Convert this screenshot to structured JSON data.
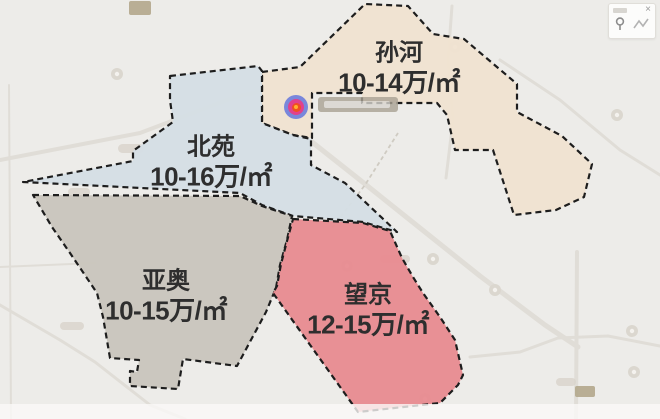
{
  "regions": [
    {
      "id": "sunhe",
      "name": "孙河",
      "price": "10-14万/㎡",
      "fill": "#f0e3d1",
      "label": {
        "x": 399,
        "y": 69
      },
      "polygon": [
        [
          262,
          72
        ],
        [
          300,
          67
        ],
        [
          365,
          4
        ],
        [
          408,
          6
        ],
        [
          433,
          34
        ],
        [
          464,
          39
        ],
        [
          517,
          84
        ],
        [
          517,
          112
        ],
        [
          562,
          136
        ],
        [
          592,
          164
        ],
        [
          584,
          197
        ],
        [
          556,
          210
        ],
        [
          514,
          215
        ],
        [
          493,
          150
        ],
        [
          455,
          150
        ],
        [
          447,
          115
        ],
        [
          437,
          103
        ],
        [
          362,
          103
        ],
        [
          362,
          93
        ],
        [
          312,
          93
        ],
        [
          312,
          138
        ],
        [
          293,
          135
        ],
        [
          262,
          123
        ]
      ]
    },
    {
      "id": "beiyuan",
      "name": "北苑",
      "price": "10-16万/㎡",
      "fill": "#d5dee5",
      "label": {
        "x": 211,
        "y": 163
      },
      "polygon": [
        [
          170,
          76
        ],
        [
          258,
          66
        ],
        [
          262,
          71
        ],
        [
          262,
          123
        ],
        [
          293,
          135
        ],
        [
          311,
          139
        ],
        [
          311,
          165
        ],
        [
          345,
          183
        ],
        [
          397,
          232
        ],
        [
          363,
          222
        ],
        [
          293,
          216
        ],
        [
          262,
          205
        ],
        [
          240,
          193
        ],
        [
          23,
          182
        ],
        [
          133,
          161
        ],
        [
          133,
          151
        ],
        [
          173,
          122
        ],
        [
          170,
          100
        ]
      ]
    },
    {
      "id": "yaao",
      "name": "亚奥",
      "price": "10-15万/㎡",
      "fill": "#c9c5bd",
      "label": {
        "x": 166,
        "y": 297
      },
      "polygon": [
        [
          33,
          195
        ],
        [
          240,
          196
        ],
        [
          262,
          206
        ],
        [
          292,
          216
        ],
        [
          287,
          240
        ],
        [
          280,
          265
        ],
        [
          276,
          288
        ],
        [
          266,
          312
        ],
        [
          237,
          366
        ],
        [
          183,
          359
        ],
        [
          178,
          389
        ],
        [
          130,
          386
        ],
        [
          130,
          371
        ],
        [
          137,
          372
        ],
        [
          139,
          360
        ],
        [
          110,
          358
        ],
        [
          103,
          317
        ],
        [
          97,
          293
        ],
        [
          70,
          253
        ],
        [
          52,
          227
        ]
      ]
    },
    {
      "id": "wangjing",
      "name": "望京",
      "price": "12-15万/㎡",
      "fill": "#e88b90",
      "label": {
        "x": 368,
        "y": 311
      },
      "polygon": [
        [
          293,
          219
        ],
        [
          363,
          223
        ],
        [
          390,
          231
        ],
        [
          402,
          258
        ],
        [
          413,
          277
        ],
        [
          423,
          293
        ],
        [
          440,
          317
        ],
        [
          455,
          340
        ],
        [
          463,
          375
        ],
        [
          458,
          385
        ],
        [
          440,
          403
        ],
        [
          358,
          412
        ],
        [
          273,
          293
        ],
        [
          277,
          286
        ],
        [
          281,
          264
        ],
        [
          287,
          241
        ]
      ]
    }
  ],
  "marker": {
    "x": 296,
    "y": 107,
    "colors": {
      "outer": "#5b6fdd",
      "mid": "#e1418d",
      "core": "#f04e23",
      "center": "#ffb02e"
    }
  },
  "panel": {
    "close_label": "×"
  },
  "colors": {
    "background": "#edece9",
    "region_border": "#1d1d1d",
    "label_text": "#2e2e2e",
    "road": "#e0ddd7",
    "poi": "#dbd7cf",
    "badge": "#b3a78c",
    "map_label_box": "#a9a294",
    "panel_bg": "#fcfcfb"
  },
  "decor": {
    "roads": [
      {
        "points": "0,160 140,133 235,97 258,92",
        "w": 4
      },
      {
        "points": "312,142 360,180 420,228 480,276 545,325 578,347",
        "w": 5
      },
      {
        "points": "577,252 576,419",
        "w": 4
      },
      {
        "points": "470,357 520,352 558,338 608,336 660,346",
        "w": 3
      },
      {
        "points": "452,6 448,60 453,120 446,178",
        "w": 3
      },
      {
        "points": "0,305 60,340 95,362 150,405 185,419",
        "w": 3
      },
      {
        "points": "9,85 11,419",
        "w": 2
      },
      {
        "points": "0,267 95,263",
        "w": 2
      },
      {
        "points": "500,60 560,100 620,150 660,175",
        "w": 3
      }
    ],
    "subway": {
      "points": "332,228 365,185 398,133"
    },
    "pois": [
      [
        455,
        47
      ],
      [
        617,
        115
      ],
      [
        347,
        266
      ],
      [
        433,
        259
      ],
      [
        632,
        331
      ],
      [
        634,
        372
      ],
      [
        425,
        399
      ],
      [
        117,
        74
      ],
      [
        495,
        290
      ]
    ],
    "pills": [
      [
        118,
        144,
        26,
        9
      ],
      [
        68,
        188,
        22,
        8
      ],
      [
        380,
        255,
        30,
        8
      ],
      [
        556,
        378,
        20,
        8
      ],
      [
        60,
        322,
        24,
        8
      ]
    ],
    "badges": [
      [
        129,
        1,
        22,
        14
      ],
      [
        575,
        386,
        20,
        11
      ]
    ],
    "map_label_box": {
      "x": 318,
      "y": 97,
      "w": 80,
      "h": 15
    }
  }
}
